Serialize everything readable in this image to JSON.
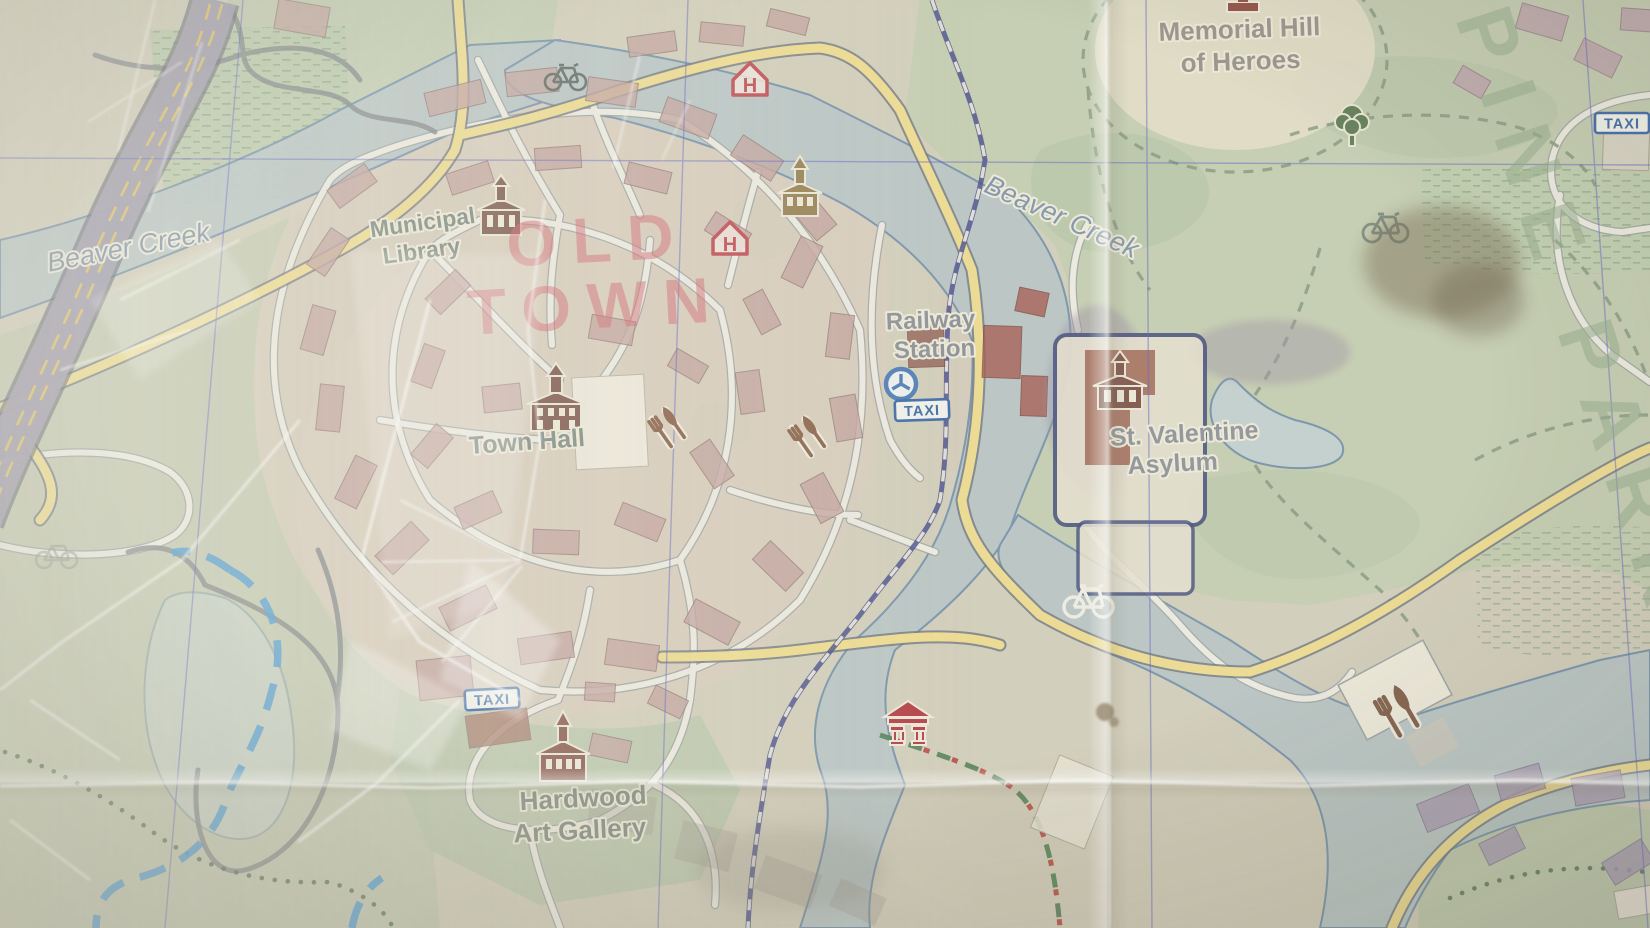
{
  "map": {
    "type": "worn-paper-town-map",
    "place_labels": {
      "beaver_creek_west": "Beaver Creek",
      "beaver_creek_east": "Beaver Creek",
      "municipal_library_1": "Municipal",
      "municipal_library_2": "Library",
      "town_hall": "Town Hall",
      "railway_station_1": "Railway",
      "railway_station_2": "Station",
      "memorial_hill_1": "Memorial Hill",
      "memorial_hill_2": "of Heroes",
      "st_valentine_1": "St. Valentine",
      "st_valentine_2": "Asylum",
      "hardwood_1": "Hardwood",
      "hardwood_2": "Art Gallery"
    },
    "districts": {
      "old_town_1": "OLD",
      "old_town_2": "TOWN",
      "pine_park": "PINE PARK"
    },
    "badges": {
      "taxi": "TAXI",
      "hotel": "H"
    },
    "icons": [
      {
        "name": "library-icon"
      },
      {
        "name": "town-hall-icon"
      },
      {
        "name": "church-icon"
      },
      {
        "name": "asylum-icon"
      },
      {
        "name": "gallery-icon"
      },
      {
        "name": "pavilion-icon"
      },
      {
        "name": "monument-icon"
      },
      {
        "name": "hotel-icon",
        "count": 2
      },
      {
        "name": "restaurant-icon",
        "count": 3
      },
      {
        "name": "bicycle-icon",
        "count": 4
      },
      {
        "name": "tree-icon"
      },
      {
        "name": "railway-station-roundel-icon"
      },
      {
        "name": "taxi-badge",
        "count": 3
      }
    ],
    "colors": {
      "paper": "#d2cebb",
      "park_green": "#c2cdb0",
      "water": "#b7c5c6",
      "water_outline": "#6d8cab",
      "road_major": "#eedc8f",
      "road_minor": "#f2efe5",
      "highway": "#a39eb1",
      "railway": "#474b8c",
      "grid_line": "#5b60c8",
      "old_town_building": "#c2a29e",
      "old_town_text": "#d4606e",
      "pine_park_text": "#96ab8e",
      "taxi_blue": "#3a66a8",
      "hotel_red": "#c04a52",
      "icon_brown": "#7b5a4d",
      "bike_route": "#4b9bd5",
      "label_grey": "#828c8e",
      "water_label": "#7e93ab"
    }
  }
}
